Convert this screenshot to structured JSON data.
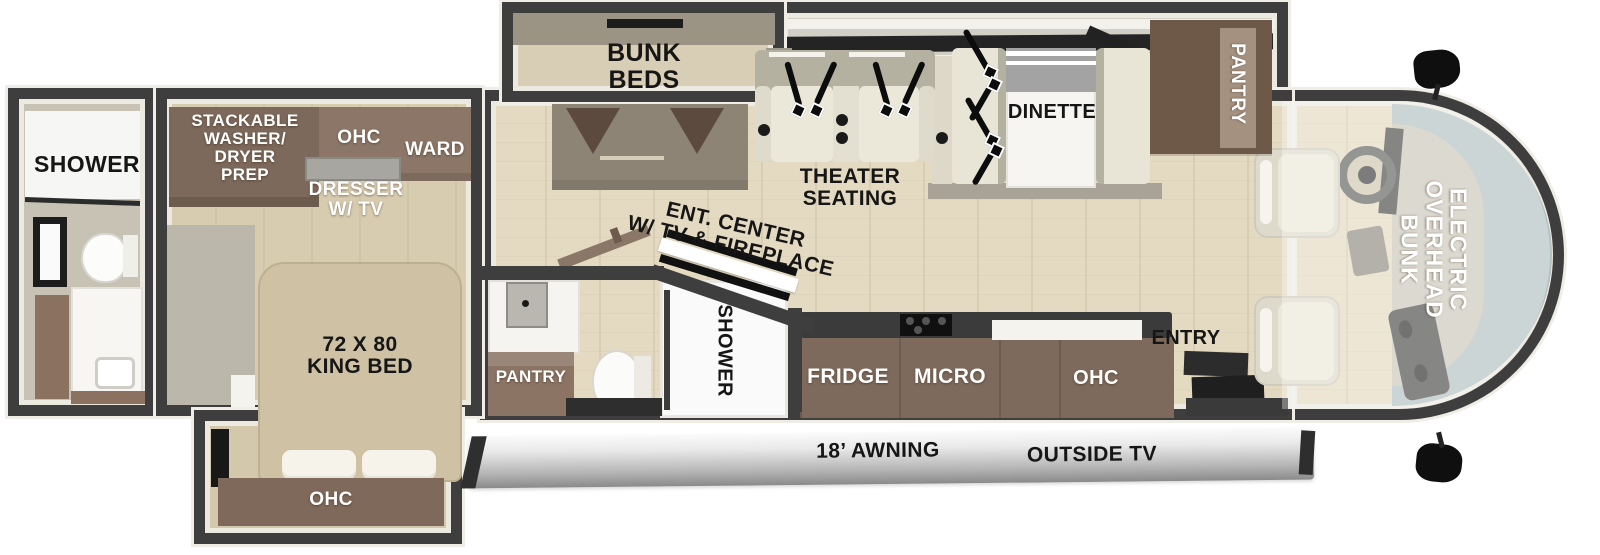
{
  "title": "Class A motorhome floor plan",
  "colors": {
    "wall": "#3e3e3e",
    "floor": "#e4dac1",
    "cabinet_brown": "#7e695c",
    "seat_cream": "#ebe7d8",
    "windshield_glass": "#b4c1c1",
    "awning_silver": "#bcbcbc",
    "label_black": "#161616",
    "label_white": "#ffffff"
  },
  "rear_bath": {
    "shower": "SHOWER"
  },
  "bedroom": {
    "stackable": "STACKABLE\nWASHER/\nDRYER\nPREP",
    "ohc": "OHC",
    "ward": "WARD",
    "dresser": "DRESSER\nW/ TV",
    "king_bed": "72 X 80\nKING BED"
  },
  "bed_slide": {
    "ohc": "OHC"
  },
  "bunk_room": {
    "bunk_beds": "BUNK\nBEDS"
  },
  "living": {
    "ent_center": "ENT. CENTER\nW/ TV & FIREPLACE",
    "theater": "THEATER\nSEATING",
    "dinette": "DINETTE",
    "pantry": "PANTRY"
  },
  "mid_bath": {
    "pantry": "PANTRY",
    "shower": "SHOWER"
  },
  "kitchen": {
    "fridge": "FRIDGE",
    "micro": "MICRO",
    "ohc": "OHC",
    "entry": "ENTRY"
  },
  "cab": {
    "overhead_bunk": "ELECTRIC\nOVERHEAD\nBUNK"
  },
  "exterior": {
    "awning": "18’ AWNING",
    "outside_tv": "OUTSIDE TV"
  }
}
